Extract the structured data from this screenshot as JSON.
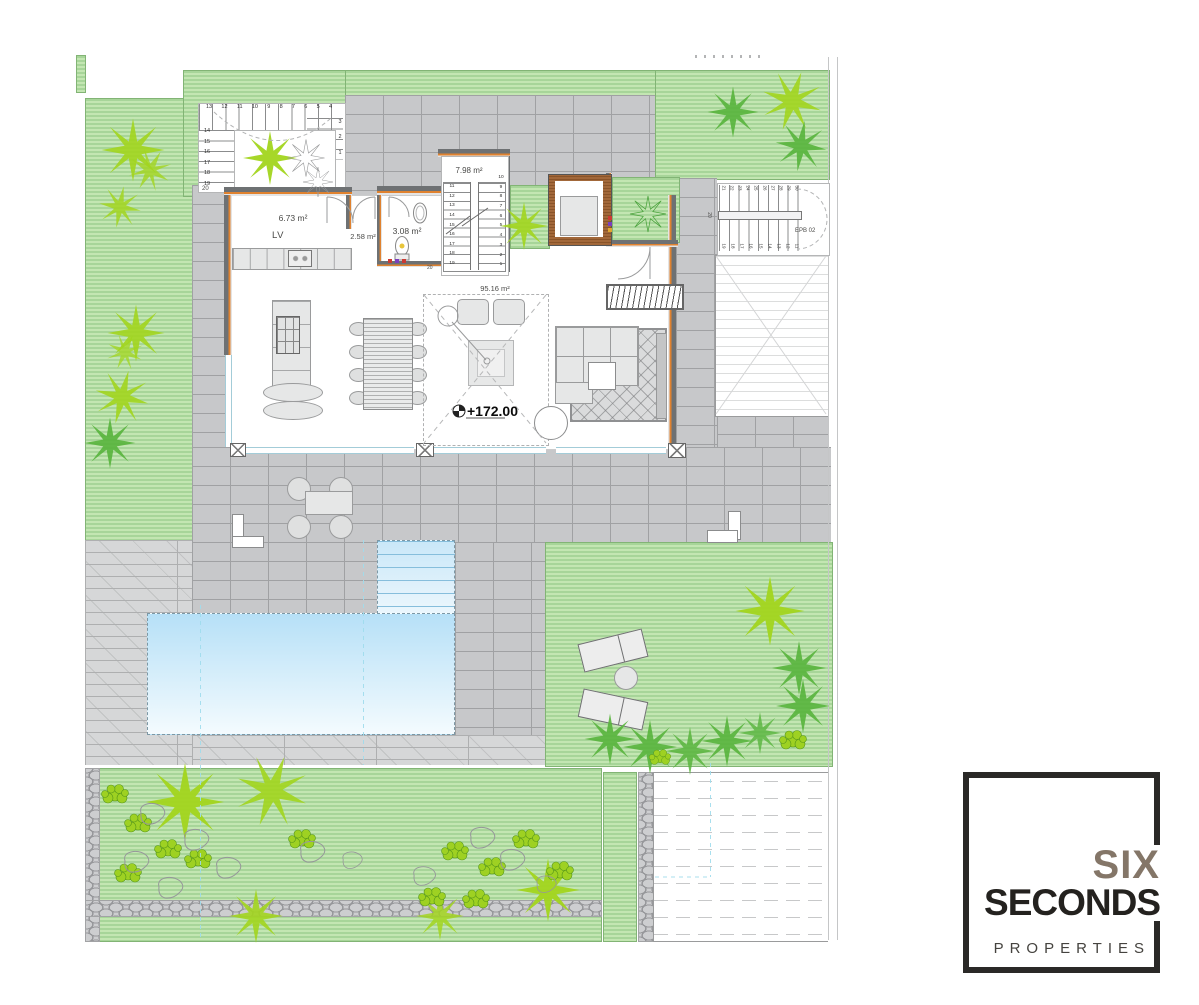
{
  "colors": {
    "lawn": "#a7d599",
    "lawnStripe": "#c3e6b2",
    "lawnEdge": "#82b475",
    "plantBright": "#a2d51e",
    "plantGreen": "#58b43c",
    "paving": "#c7c8ca",
    "pavingLine": "#a0a1a3",
    "deck": "#d6d7d8",
    "deckLine": "#aeafb0",
    "stone": "#cdced0",
    "stoneLine": "#96979a",
    "wall": "#6e7173",
    "insulation": "#e0822f",
    "brick": "#a2683a",
    "poolTop": "#b6e0f7",
    "poolBottom": "#f4fbfe",
    "poolLine": "#86bedc",
    "window": "#a3ccd8",
    "furn": "#e6e7e7",
    "furnLine": "#9a9b9c",
    "label": "#4a4a48",
    "guide": "#9fdcec",
    "logoSix": "#847668",
    "logoDark": "#24221f",
    "logoGray": "#45433f",
    "logoBorder": "#2a2927"
  },
  "labels": {
    "kitchen_area": "6.73 m²",
    "kitchen_lv": "LV",
    "hall_area": "2.58 m²",
    "bath_area": "3.08 m²",
    "stair_area": "7.98 m²",
    "living_area": "95.16 m²",
    "level": "+172.00",
    "stair_ref": "EPB 02",
    "step20": "20"
  },
  "stairs": {
    "outer_top": "13 12 11 10 9 8 7 6 5 4",
    "outer_left": "14 15 16 17 18 19",
    "outer_right": "3 2 1",
    "inner_left": "11 12 13 14 15 16 17 18 19",
    "inner_right": "10 9 8 7 6 5 4 3 2 1",
    "epb_top": "21 22 23 24 25 26 27 28 29 30",
    "epb_bottom": "19 18 17 16 15 14 13 12 11"
  },
  "logo": {
    "brand_top": "SIX",
    "brand_main": "SECONDS",
    "brand_sub": "PROPERTIES"
  }
}
